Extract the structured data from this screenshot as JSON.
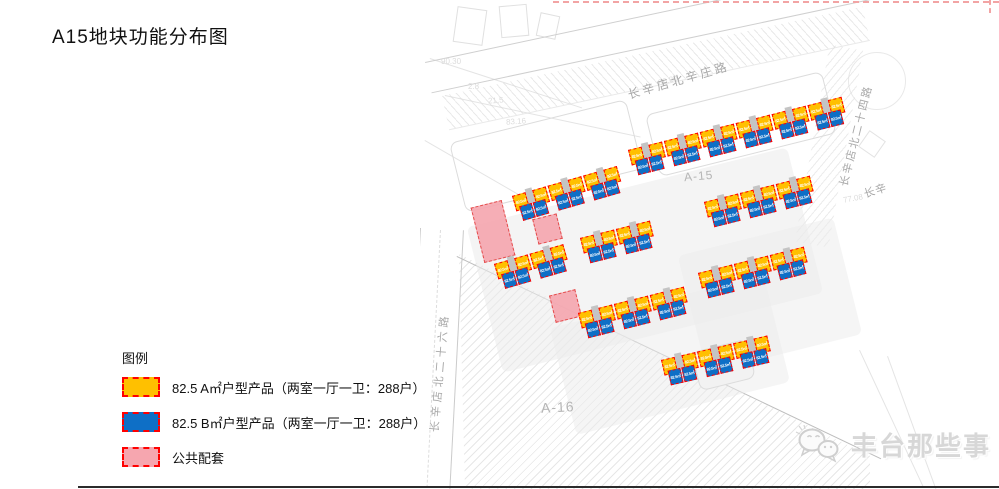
{
  "title": "A15地块功能分布图",
  "legend": {
    "heading": "图例",
    "items": [
      {
        "label": "82.5 A㎡户型产品（两室一厅一卫：288户）",
        "color_key": "unit_a"
      },
      {
        "label": "82.5 B㎡户型产品（两室一厅一卫：288户）",
        "color_key": "unit_b"
      },
      {
        "label": "公共配套",
        "color_key": "public"
      }
    ]
  },
  "watermark": {
    "text": "丰台那些事",
    "icon": "wechat-bubbles-icon"
  },
  "colors": {
    "unit_a": "#FFC000",
    "unit_b": "#0E6FC6",
    "public": "#F6A6AF",
    "swatch_border": "#FF0000",
    "road_text": "#A8A8A8",
    "plot_text": "#B5B5B5"
  },
  "map": {
    "unit_label": "82.5㎡",
    "plot_labels": [
      {
        "text": "A-15",
        "x": 264,
        "y": 169,
        "size": 12,
        "rot": -5
      },
      {
        "text": "A-16",
        "x": 121,
        "y": 399,
        "size": 14,
        "rot": -3
      }
    ],
    "road_labels": [
      {
        "text": "长辛店北辛庄路",
        "x": 208,
        "y": 86,
        "rot": -16,
        "size": 12,
        "spacing": 3
      },
      {
        "text": "长辛店北二十四路",
        "x": 423,
        "y": 178,
        "rot": -76,
        "size": 11,
        "spacing": 2
      },
      {
        "text": "长辛店北二十六路",
        "x": 14,
        "y": 424,
        "rot": -85,
        "size": 11,
        "spacing": 4
      },
      {
        "text": "长辛",
        "x": 444,
        "y": 186,
        "rot": -18,
        "size": 11,
        "spacing": 1
      }
    ],
    "elevation_marks": [
      {
        "text": "80.80",
        "x": 238,
        "y": 76,
        "rot": -14
      },
      {
        "text": "83.16",
        "x": 86,
        "y": 117,
        "rot": -4
      },
      {
        "text": "90.30",
        "x": 21,
        "y": 57,
        "rot": 0
      },
      {
        "text": "2.8",
        "x": 48,
        "y": 82,
        "rot": 0
      },
      {
        "text": "21.5",
        "x": 68,
        "y": 96,
        "rot": -4
      },
      {
        "text": "77.08",
        "x": 423,
        "y": 194,
        "rot": -10
      }
    ],
    "building_rows": [
      {
        "x": 208,
        "y": 150,
        "rot": -14,
        "clusters": 6
      },
      {
        "x": 92,
        "y": 196,
        "rot": -16,
        "clusters": 3
      },
      {
        "x": 284,
        "y": 202,
        "rot": -14,
        "clusters": 3
      },
      {
        "x": 160,
        "y": 238,
        "rot": -14,
        "clusters": 2
      },
      {
        "x": 74,
        "y": 264,
        "rot": -16,
        "clusters": 2
      },
      {
        "x": 278,
        "y": 273,
        "rot": -14,
        "clusters": 3
      },
      {
        "x": 158,
        "y": 313,
        "rot": -14,
        "clusters": 3
      },
      {
        "x": 241,
        "y": 360,
        "rot": -13,
        "clusters": 3
      }
    ],
    "public_areas": [
      {
        "x": 57,
        "y": 203,
        "w": 30,
        "h": 55,
        "rot": -14
      },
      {
        "x": 115,
        "y": 216,
        "w": 23,
        "h": 24,
        "rot": -14
      },
      {
        "x": 132,
        "y": 292,
        "w": 25,
        "h": 26,
        "rot": -14
      }
    ]
  }
}
